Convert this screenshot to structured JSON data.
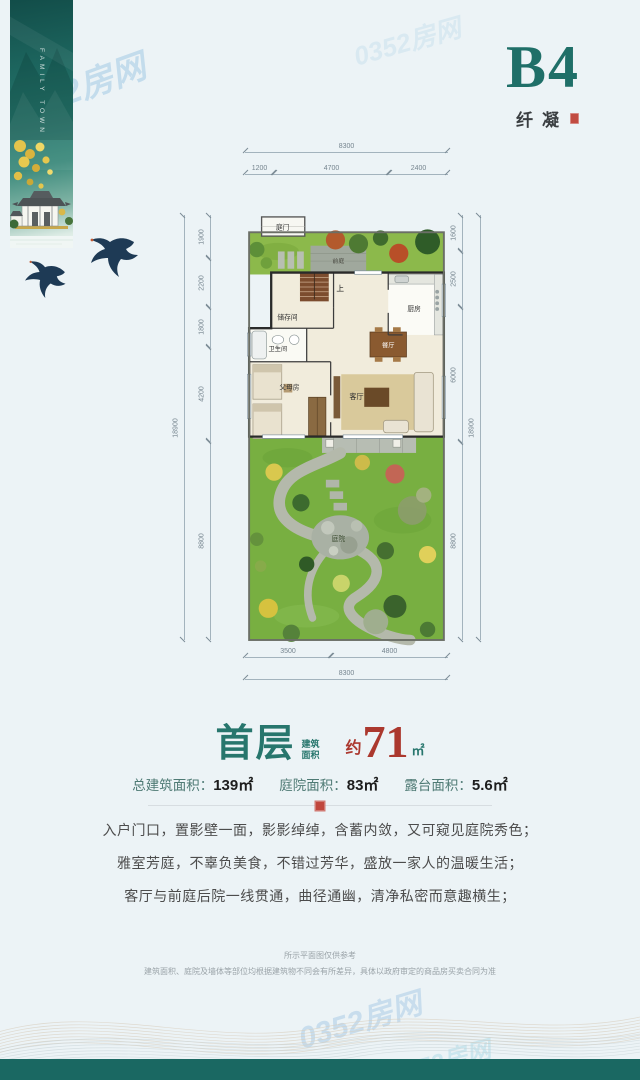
{
  "watermark": {
    "text": "0352房网"
  },
  "banner": {
    "vertical_text": "FAMILY TOWN"
  },
  "header": {
    "unit_code": "B4",
    "unit_name": "纤凝"
  },
  "plan": {
    "rooms": {
      "gate": "庭门",
      "front_yard": "前庭",
      "storage": "储存间",
      "stairs_up": "上",
      "kitchen": "厨房",
      "bathroom": "卫生间",
      "dining": "餐厅",
      "parents_room": "父母房",
      "living": "客厅",
      "courtyard": "庭院"
    },
    "dims": {
      "top_total": "8300",
      "top_segments": [
        "1200",
        "4700",
        "2400"
      ],
      "left_total": "18900",
      "left_segments": [
        "1900",
        "2200",
        "1800",
        "4200",
        "8800"
      ],
      "right_segments": [
        "1600",
        "2500",
        "6000",
        "8800"
      ],
      "right_total": "18900",
      "bottom_segments": [
        "3500",
        "4800"
      ],
      "bottom_total": "8300"
    }
  },
  "summary": {
    "floor_label": "首层",
    "area_caption_top": "建筑",
    "area_caption_bottom": "面积",
    "approx_prefix": "约",
    "area_value": "71",
    "area_unit": "㎡",
    "stats": [
      {
        "label": "总建筑面积：",
        "value": "139㎡"
      },
      {
        "label": "庭院面积：",
        "value": "83㎡"
      },
      {
        "label": "露台面积：",
        "value": "5.6㎡"
      }
    ]
  },
  "description": {
    "lines": [
      "入户门口，置影壁一面，影影绰绰，含蓄内敛，又可窥见庭院秀色；",
      "雅室芳庭，不辜负美食，不错过芳华，盛放一家人的温暖生活；",
      "客厅与前庭后院一线贯通，曲径通幽，清净私密而意趣横生；"
    ]
  },
  "disclaimer": {
    "line1": "所示平面图仅供参考",
    "line2": "建筑面积、庭院及墙体等部位均根据建筑物不同会有所差异，具体以政府审定的商品房买卖合同为准"
  },
  "colors": {
    "accent_teal": "#1f6f68",
    "accent_red": "#b23a31",
    "dim_line": "#8fa3ad"
  }
}
